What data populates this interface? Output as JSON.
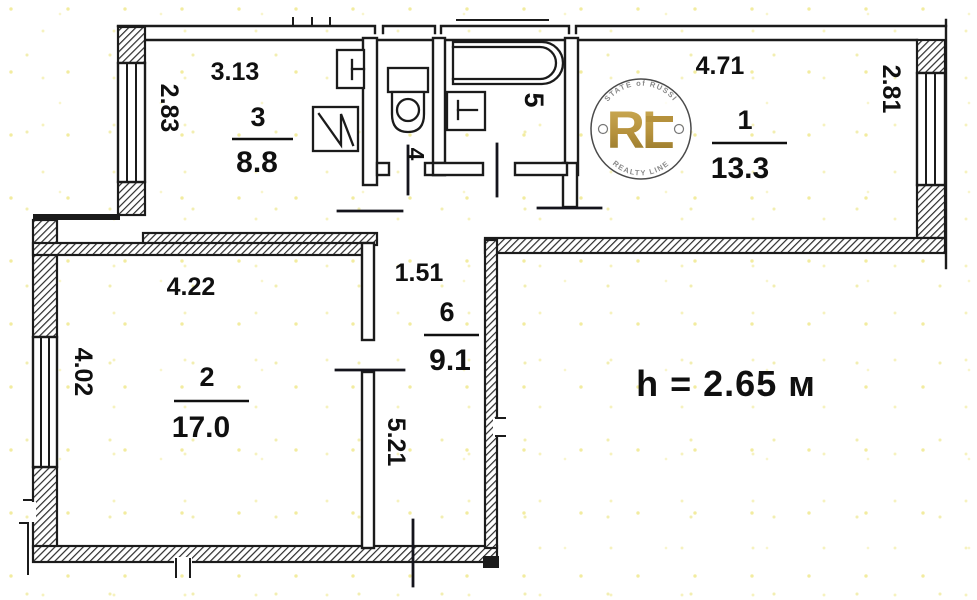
{
  "plan": {
    "ceiling_height_label": "h = 2.65 м",
    "rooms": [
      {
        "number": "1",
        "area": "13.3",
        "width_dim": "4.71",
        "height_dim": "2.81"
      },
      {
        "number": "2",
        "area": "17.0",
        "width_dim": "4.22",
        "height_dim": "4.02"
      },
      {
        "number": "3",
        "area": "8.8",
        "width_dim": "3.13",
        "height_dim": "2.83"
      },
      {
        "number": "4"
      },
      {
        "number": "5"
      },
      {
        "number": "6",
        "area": "9.1",
        "width_dim": "1.51",
        "height_dim": "5.21"
      }
    ]
  },
  "watermark": {
    "monogram": "RL",
    "arc_top": "ESTATE of RUSSIA",
    "arc_bottom": "REALTY LINE"
  },
  "colors": {
    "ink": "#1b1b1b",
    "gold": "#b5913c",
    "watermark_ring": "#4a4a4a",
    "watermark_text": "#8a8a8a",
    "speckle": "#e8dc5a"
  }
}
